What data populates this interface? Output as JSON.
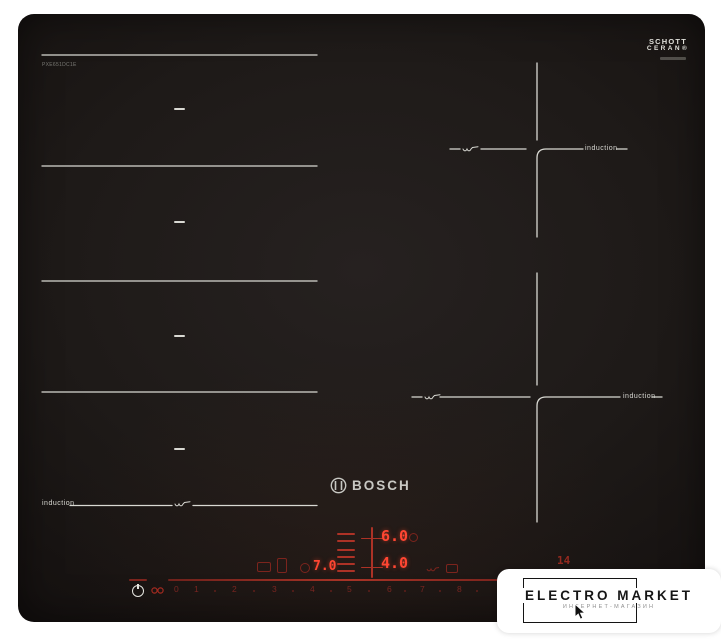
{
  "product": {
    "brand": "BOSCH",
    "model_label": "PXE651DC1E",
    "glass_logo": {
      "line1": "SCHOTT",
      "line2": "CERAN®"
    }
  },
  "zone_labels": {
    "left": "induction",
    "top_right": "induction",
    "bottom_right": "induction"
  },
  "controls": {
    "display_top": "6.0",
    "display_bottom": "4.0",
    "display_left": "7.0",
    "timer": "14",
    "scale_numbers": [
      "0",
      "1",
      "2",
      "3",
      "4",
      "5",
      "6",
      "7",
      "8"
    ]
  },
  "watermark": {
    "title": "ELECTRO MARKET",
    "subtitle": "ИНТЕРНЕТ-МАГАЗИН"
  },
  "colors": {
    "background": "#ffffff",
    "hob_black": "#1d1917",
    "marking_white": "#d9d9d3",
    "display_red_bright": "#ff4632",
    "display_red_dim": "#7c241d"
  }
}
